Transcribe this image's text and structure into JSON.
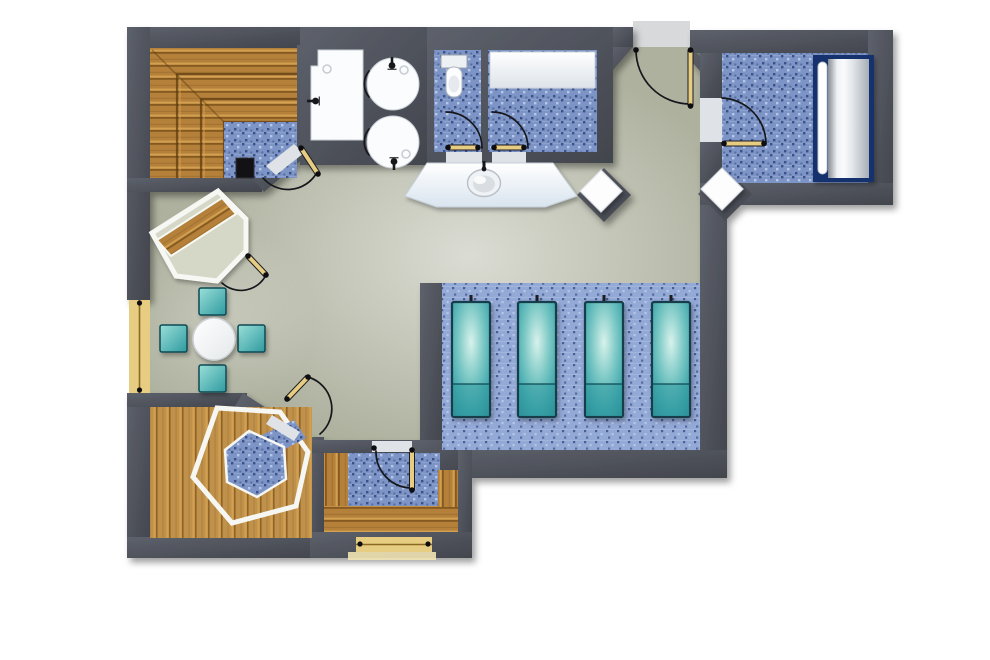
{
  "meta": {
    "title": "Spa / wellness area floor plan (top-down architectural rendering)",
    "canvas": {
      "width": 990,
      "height": 660
    },
    "style": "3D rendered plan, no text labels"
  },
  "colors": {
    "wall": "#4d5059",
    "wallLight": "#5d616b",
    "wallDark": "#42454d",
    "hallFloor": "#aeb19e",
    "hallLight": "#cdd0bc",
    "tileBase": "#7d95c6",
    "tileDark": "#3d5186",
    "tileLight": "#b7c5e6",
    "tilePlatform": "#93a9d6",
    "woodMid": "#b5813a",
    "woodDark": "#85591f",
    "woodLight": "#d2a050",
    "woodHex": "#c0914a",
    "teal": "#4fb1b4",
    "tealLight": "#cfeee9",
    "tealDark": "#124a52",
    "navy": "#16336e",
    "tan": "#e7cd82",
    "tanDark": "#a98634",
    "fixtureWhite": "#fbfcfe",
    "exterior": "#ffffff",
    "entrancePad": "#d7d9da"
  },
  "rooms": {
    "hall": {
      "name": "Relaxation hall with open seating"
    },
    "sauna": {
      "name": "Finnish sauna with tiered benches and heater"
    },
    "showers": {
      "name": "Shower area with two round shower stalls"
    },
    "wc": {
      "name": "WC with toilet"
    },
    "changing": {
      "name": "Changing room with bench"
    },
    "corridor": {
      "name": "Entrance corridor"
    },
    "massage": {
      "name": "Treatment room with soft-pack bed"
    },
    "platform": {
      "name": "Raised platform with four heated loungers"
    },
    "steam": {
      "name": "Steam bath with hexagonal tiled basin"
    },
    "cabin": {
      "name": "Small sauna cabin with U-shaped benches"
    },
    "dining": {
      "name": "Seating corner with round table"
    },
    "booth": {
      "name": "Corner booth with diagonal wooden bench"
    }
  },
  "furniture": {
    "saunaHeater": {
      "name": "Sauna heater (stove)"
    },
    "saunaBenches": {
      "name": "L-shaped tiered sauna benches",
      "tiers": 3
    },
    "roundShowers": {
      "name": "Round shower stall",
      "count": 2
    },
    "wallShower": {
      "name": "Wall-mounted shower"
    },
    "toilet": {
      "name": "Toilet with cistern"
    },
    "changingBench": {
      "name": "Changing bench"
    },
    "vanity": {
      "name": "Vanity counter with oval washbasin and faucet"
    },
    "treatmentBed": {
      "name": "Soft-pack treatment bed with side rail"
    },
    "cornerSeats": {
      "name": "White corner seat in chamfered niche",
      "count": 2
    },
    "loungers": {
      "name": "Heated relaxation lounger",
      "count": 4
    },
    "table": {
      "name": "Round white table"
    },
    "stools": {
      "name": "Teal upholstered stool",
      "count": 4
    },
    "hexBasin": {
      "name": "Hexagonal white-trimmed bench ring with blue tile centre"
    },
    "windows": {
      "name": "Window in wall",
      "count": 2
    },
    "doors": {
      "name": "Swing door with arc",
      "count": 8
    }
  }
}
